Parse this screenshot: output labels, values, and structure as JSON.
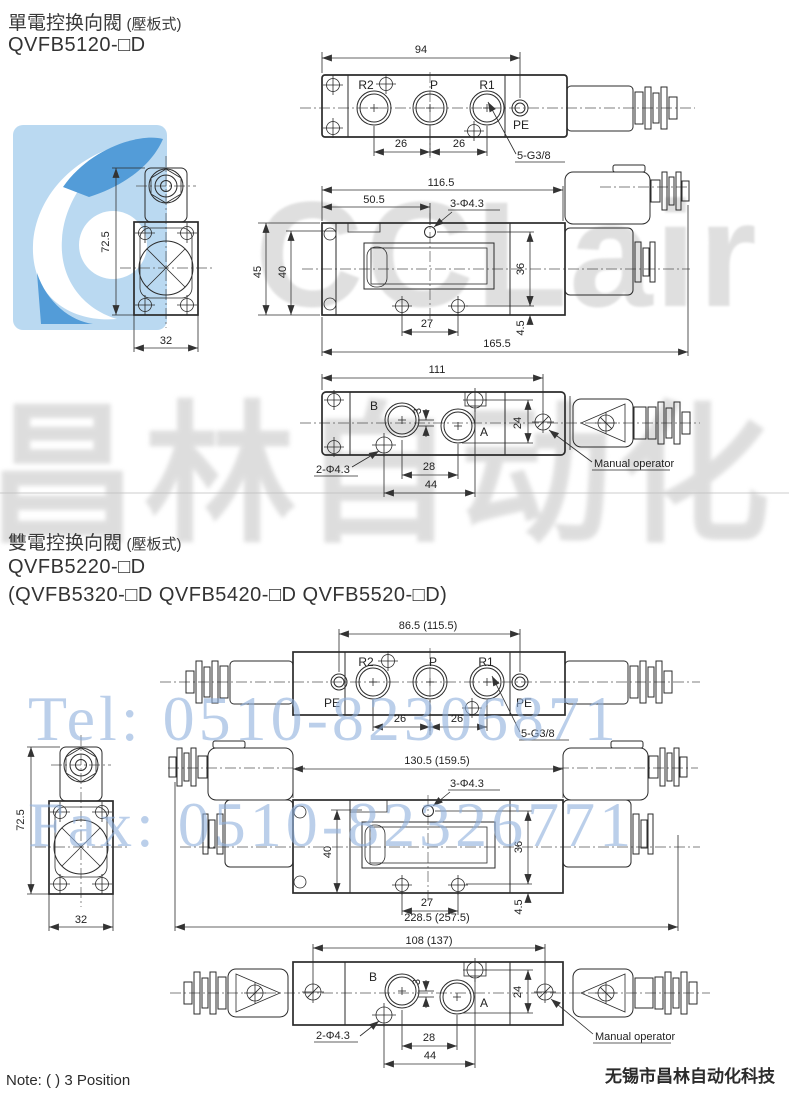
{
  "watermarks": {
    "brand_text": "CCLair",
    "brand_cn": "昌林自动化",
    "tel": "Tel: 0510-82306871",
    "fax": "Fax: 0510-82326771",
    "logo_bg_color": "#b7d8f1",
    "logo_accent_color": "#4a97d6",
    "gray_text_color": "#c6c6c6",
    "blue_text_color": "#8fb0dd"
  },
  "section1": {
    "title": "單電控换向閥",
    "title_note": "(壓板式)",
    "model": "QVFB5120-□D",
    "top_view": {
      "dim_overall": "94",
      "port_r2": "R2",
      "port_p": "P",
      "port_r1": "R1",
      "label_pe": "PE",
      "dim_left": "26",
      "dim_right": "26",
      "thread_note": "5-G3/8"
    },
    "end_view": {
      "dim_height": "72.5",
      "dim_width": "32"
    },
    "side_view": {
      "dim_overall": "116.5",
      "dim_partial": "50.5",
      "hole_note": "3-Φ4.3",
      "dim_h1": "45",
      "dim_h2": "40",
      "dim_h3": "36",
      "dim_bottom": "27",
      "dim_offset": "4.5",
      "dim_total": "165.5"
    },
    "bottom_view": {
      "dim_overall": "111",
      "port_b": "B",
      "port_a": "A",
      "dim_small": "3",
      "dim_v": "24",
      "dim_c1": "28",
      "dim_c2": "44",
      "hole_note": "2-Φ4.3",
      "manual_label": "Manual operator"
    }
  },
  "section2": {
    "title": "雙電控换向閥",
    "title_note": "(壓板式)",
    "model": "QVFB5220-□D",
    "models_alt": "(QVFB5320-□D  QVFB5420-□D  QVFB5520-□D)",
    "top_view": {
      "dim_overall": "86.5 (115.5)",
      "port_r2": "R2",
      "port_p": "P",
      "port_r1": "R1",
      "label_pe_left": "PE",
      "label_pe_right": "PE",
      "dim_left": "26",
      "dim_right": "26",
      "thread_note": "5-G3/8"
    },
    "end_view": {
      "dim_height": "72.5",
      "dim_width": "32"
    },
    "side_view": {
      "dim_overall": "130.5 (159.5)",
      "hole_note": "3-Φ4.3",
      "dim_h2": "40",
      "dim_h3": "36",
      "dim_bottom": "27",
      "dim_offset": "4.5",
      "dim_total": "228.5 (257.5)"
    },
    "bottom_view": {
      "dim_overall": "108 (137)",
      "port_b": "B",
      "port_a": "A",
      "dim_small": "3",
      "dim_v": "24",
      "dim_c1": "28",
      "dim_c2": "44",
      "hole_note": "2-Φ4.3",
      "manual_label": "Manual operator"
    }
  },
  "footer": {
    "note": "Note: ( ) 3 Position",
    "company": "无锡市昌林自动化科技"
  }
}
